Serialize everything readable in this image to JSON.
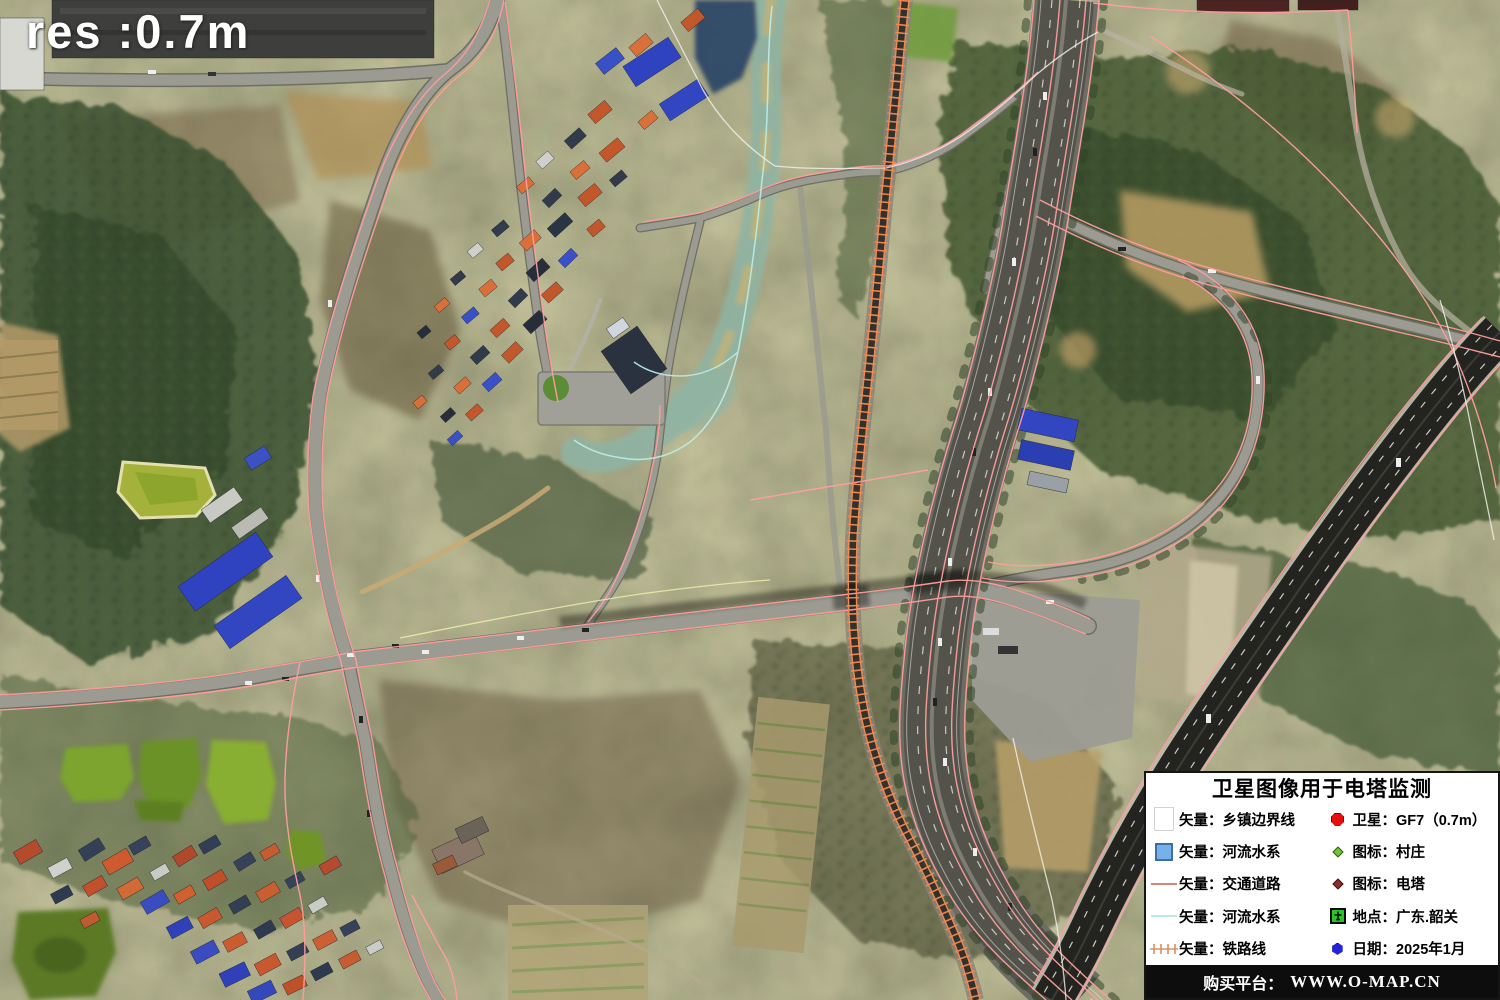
{
  "overlay": {
    "resolution_label": "res :0.7m"
  },
  "legend": {
    "title": "卫星图像用于电塔监测",
    "left_items": [
      {
        "symbol": "township-boundary-swatch",
        "label": "矢量：乡镇边界线"
      },
      {
        "symbol": "river-polygon-swatch",
        "label": "矢量：河流水系"
      },
      {
        "symbol": "traffic-road-swatch",
        "label": "矢量：交通道路"
      },
      {
        "symbol": "river-line-swatch",
        "label": "矢量：河流水系"
      },
      {
        "symbol": "railway-line-swatch",
        "label": "矢量：铁路线"
      }
    ],
    "right_items": [
      {
        "symbol": "satellite-dot",
        "label": "卫星：GF7（0.7m）"
      },
      {
        "symbol": "village-diamond",
        "label": "图标：村庄"
      },
      {
        "symbol": "tower-diamond",
        "label": "图标：电塔"
      },
      {
        "symbol": "location-icon",
        "label": "地点：广东.韶关"
      },
      {
        "symbol": "date-dot",
        "label": "日期：2025年1月"
      }
    ],
    "footer_prefix": "购买平台：",
    "footer_url": "WWW.O-MAP.CN"
  },
  "colors": {
    "vector_road_pink": "#ff9e9e",
    "vector_railway_orange": "#ef8a55",
    "vector_river_cyan": "#bdeee6",
    "vector_boundary_white": "#f4f2ee",
    "river_polygon_blue": "#77b1e9",
    "satellite_dot_red": "#e60f0f",
    "village_green": "#72c437",
    "tower_maroon": "#8f2d2d",
    "date_blue": "#2424da",
    "legend_background": "#ffffff",
    "footer_background": "#0d0d0d"
  }
}
